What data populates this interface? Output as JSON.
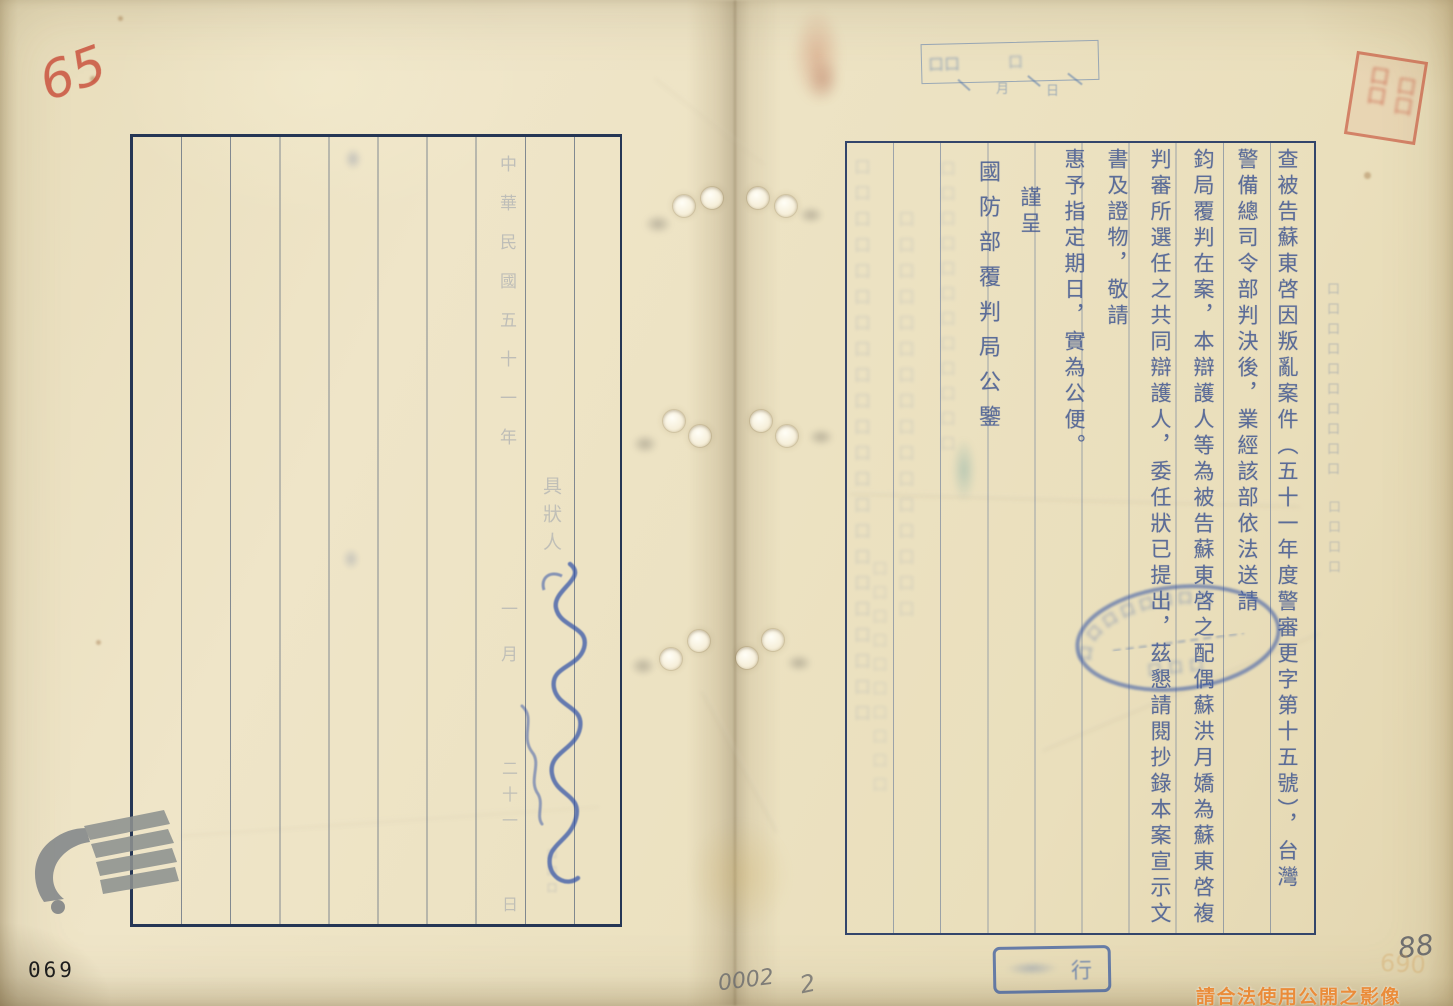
{
  "page": {
    "watermark_bottom_right": "請合法使用公開之影像",
    "archive_serial": "069",
    "corner_mark_top_left": "65",
    "pencil_center": "0002",
    "pencil_center_small": "2",
    "pencil_right": "88",
    "pencil_right_faint": "690"
  },
  "right_page": {
    "columns": [
      {
        "text": "查被告蘇東啓因叛亂案件（五十一年度警審更字第十五號），台灣"
      },
      {
        "text": "警備總司令部判決後，業經該部依法送請"
      },
      {
        "text": "鈞局覆判在案，本辯護人等為被告蘇東啓之配偶蘇洪月嬌為蘇東啓複"
      },
      {
        "text": "判審所選任之共同辯護人，委任狀已提出，茲懇請閱抄錄本案宣示文"
      },
      {
        "text": "書及證物，敬請"
      },
      {
        "text": "惠予指定期日，實為公便。"
      },
      {
        "text": "謹呈"
      },
      {
        "text": "國防部覆判局公鑒"
      }
    ],
    "margin_label_illegible_a": "口口口口口口口口口口",
    "margin_label_illegible_b": "口口口口"
  },
  "left_page": {
    "date_segment_year": "中華民國五十一年",
    "date_segment_month": "一月",
    "date_segment_day": "二十一",
    "date_segment_ri": "日",
    "petitioner_label": "具狀人",
    "tiny_filler": "口口口"
  },
  "stamps": {
    "receipt_filler_left": "口口",
    "receipt_filler_mid": "口",
    "receipt_below_month": "月",
    "receipt_below_day": "日",
    "red_seal_filler_a": "口口",
    "red_seal_filler_b": "口口",
    "oval_arc_filler": "口口口口口口口口",
    "oval_bottom_filler": "口口口",
    "bottom_box_char": "行"
  },
  "bleedthrough": {
    "col_a": "口口口口口口口口口口口口口口口口口口口口口口",
    "col_b": "口口口口口口口口口口口口口口口口",
    "col_c": "口口口口口口口口口口口口",
    "col_d": "口口口口口口口口口口"
  }
}
